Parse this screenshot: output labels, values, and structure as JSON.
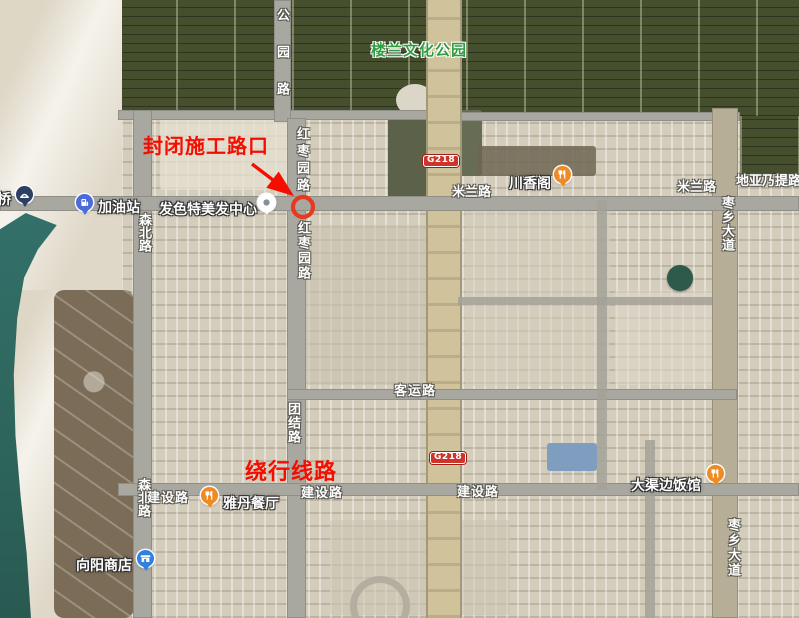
{
  "map": {
    "park_label": {
      "text": "楼兰文化公园"
    },
    "annotations": {
      "closed_intersection": "封闭施工路口",
      "detour_route": "绕行线路"
    },
    "road_shields": [
      {
        "id": "g218-north",
        "text": "G218",
        "x": 423,
        "y": 155
      },
      {
        "id": "g218-south",
        "text": "G218",
        "x": 430,
        "y": 452
      }
    ],
    "road_labels": [
      {
        "id": "gongyuan-road",
        "text": "公园路",
        "orientation": "vertical",
        "x": 273,
        "y": 8,
        "spacing": 24
      },
      {
        "id": "hongzaoyuan-road-1",
        "text": "红枣园路",
        "orientation": "vertical",
        "x": 293,
        "y": 127,
        "spacing": 4
      },
      {
        "id": "hongzaoyuan-road-2",
        "text": "红枣园路",
        "orientation": "vertical",
        "x": 294,
        "y": 221,
        "spacing": 2
      },
      {
        "id": "milan-road-1",
        "text": "米兰路",
        "orientation": "horizontal",
        "x": 452,
        "y": 186,
        "spacing": 0
      },
      {
        "id": "milan-road-2",
        "text": "米兰路",
        "orientation": "horizontal",
        "x": 677,
        "y": 181,
        "spacing": 0
      },
      {
        "id": "diyanati-road",
        "text": "地亚乃提路",
        "orientation": "horizontal",
        "x": 736,
        "y": 175,
        "spacing": 0
      },
      {
        "id": "zaoxiang-avenue-1",
        "text": "枣乡大道",
        "orientation": "vertical",
        "x": 718,
        "y": 196,
        "spacing": 1
      },
      {
        "id": "zaoxiang-avenue-2",
        "text": "枣乡大道",
        "orientation": "vertical",
        "x": 724,
        "y": 518,
        "spacing": 2
      },
      {
        "id": "senbei-road-1",
        "text": "森北路",
        "orientation": "vertical",
        "x": 135,
        "y": 213,
        "spacing": 0
      },
      {
        "id": "senbei-road-2",
        "text": "森北路",
        "orientation": "vertical",
        "x": 134,
        "y": 478,
        "spacing": 0
      },
      {
        "id": "tuanjie-road",
        "text": "团结路",
        "orientation": "vertical",
        "x": 284,
        "y": 402,
        "spacing": 1
      },
      {
        "id": "keyun-road",
        "text": "客运路",
        "orientation": "horizontal",
        "x": 394,
        "y": 385,
        "spacing": 1
      },
      {
        "id": "jianshe-road-1",
        "text": "建设路",
        "orientation": "horizontal",
        "x": 147,
        "y": 492,
        "spacing": 1
      },
      {
        "id": "jianshe-road-2",
        "text": "建设路",
        "orientation": "horizontal",
        "x": 301,
        "y": 487,
        "spacing": 1
      },
      {
        "id": "jianshe-road-3",
        "text": "建设路",
        "orientation": "horizontal",
        "x": 457,
        "y": 486,
        "spacing": 1
      }
    ],
    "pois": [
      {
        "id": "bridge",
        "label": "桥",
        "icon": "bridge-icon",
        "pin_color": "#2e3f66",
        "pin": {
          "x": 16,
          "y": 186
        },
        "label_pos": {
          "x": -3,
          "y": 189
        }
      },
      {
        "id": "gas-station",
        "label": "加油站",
        "icon": "fuel-icon",
        "pin_color": "#4a6bd8",
        "pin": {
          "x": 76,
          "y": 194
        },
        "label_pos": {
          "x": 98,
          "y": 197
        }
      },
      {
        "id": "hair-salon",
        "label": "发色特美发中心",
        "icon": "dot-icon",
        "pin_color": "#ffffff",
        "pin": {
          "x": 258,
          "y": 194
        },
        "label_pos": {
          "x": 159,
          "y": 199
        }
      },
      {
        "id": "chuanxiangge",
        "label": "川香阁",
        "icon": "restaurant-icon",
        "pin_color": "#f08a23",
        "pin": {
          "x": 554,
          "y": 166
        },
        "label_pos": {
          "x": 509,
          "y": 173
        }
      },
      {
        "id": "yadan-restaurant",
        "label": "雅丹餐厅",
        "icon": "restaurant-icon",
        "pin_color": "#f08a23",
        "pin": {
          "x": 201,
          "y": 487
        },
        "label_pos": {
          "x": 223,
          "y": 493
        }
      },
      {
        "id": "daqubian-restaurant",
        "label": "大渠边饭馆",
        "icon": "restaurant-icon",
        "pin_color": "#f08a23",
        "pin": {
          "x": 707,
          "y": 465
        },
        "label_pos": {
          "x": 631,
          "y": 475
        }
      },
      {
        "id": "xiangyang-store",
        "label": "向阳商店",
        "icon": "shop-icon",
        "pin_color": "#2f80e0",
        "pin": {
          "x": 137,
          "y": 550
        },
        "label_pos": {
          "x": 76,
          "y": 555
        }
      }
    ],
    "colors": {
      "annotation_red": "#f50d00",
      "ring_red": "#e8391f",
      "shield_bg": "#cf342a",
      "park_green": "#2f9e3f",
      "water": "#2e675e"
    }
  }
}
